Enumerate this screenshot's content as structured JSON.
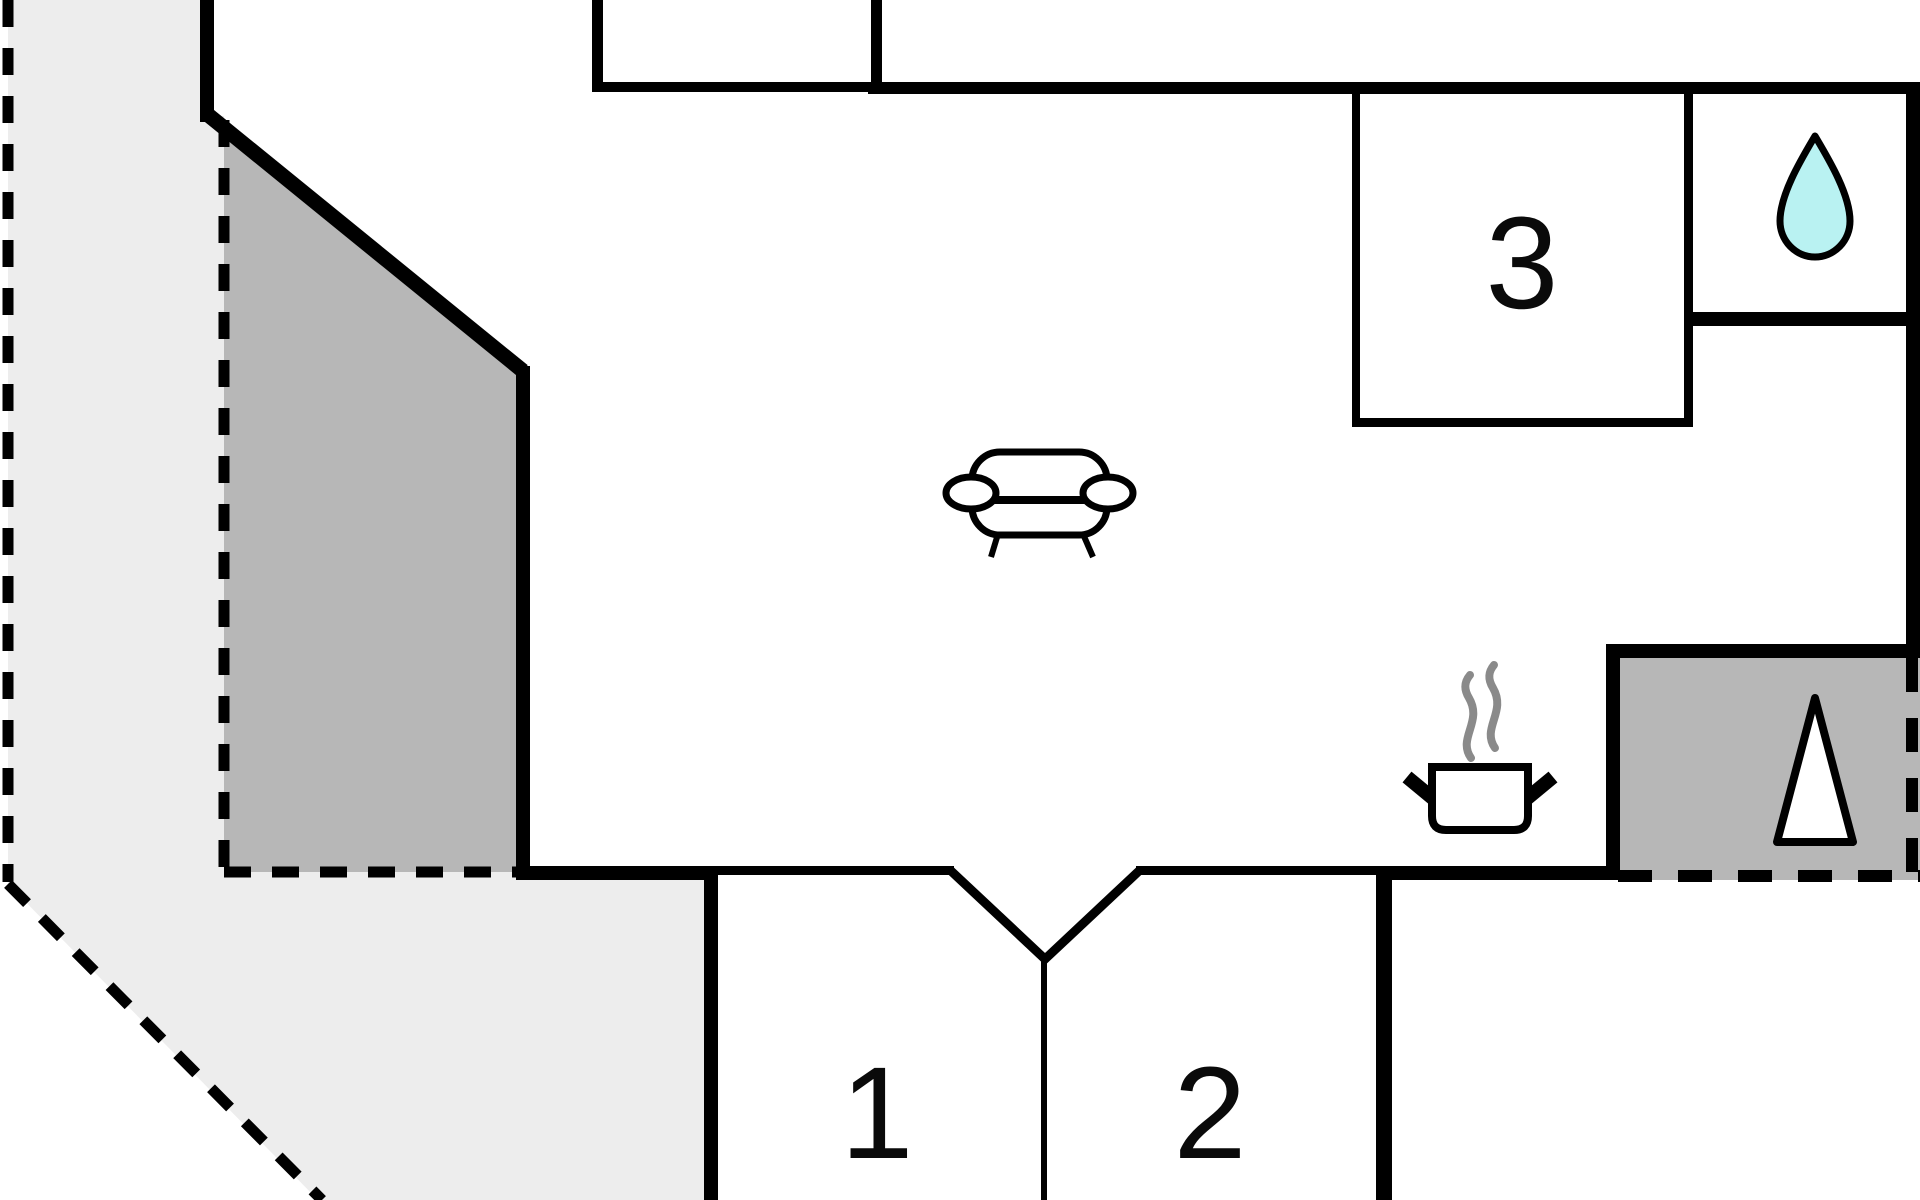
{
  "floorplan": {
    "title": "holiday-home floor plan",
    "rooms": [
      {
        "name": "bedroom-1",
        "label": "1"
      },
      {
        "name": "bedroom-2",
        "label": "2"
      },
      {
        "name": "room-3",
        "label": "3"
      }
    ],
    "icons": [
      {
        "name": "sofa-icon",
        "meaning": "living room seating"
      },
      {
        "name": "water-drop-icon",
        "meaning": "bathroom / water"
      },
      {
        "name": "cooking-pot-icon",
        "meaning": "kitchen / stove"
      },
      {
        "name": "steam-icon",
        "meaning": "steam above pot"
      },
      {
        "name": "fireplace-triangle-icon",
        "meaning": "fireplace / sauna stove"
      }
    ],
    "areas": [
      {
        "name": "terrace-light",
        "style": "light gray, dashed boundary"
      },
      {
        "name": "terrace-dark",
        "style": "dark gray, dashed boundary"
      },
      {
        "name": "annex-dark-box",
        "style": "dark gray, dashed outer boundary"
      }
    ],
    "colors": {
      "wall": "#000000",
      "background": "#ffffff",
      "terrace_light": "#ededed",
      "terrace_dark": "#b7b7b7",
      "water_drop": "#b9f2f2",
      "steam": "#8a8a8a"
    }
  }
}
